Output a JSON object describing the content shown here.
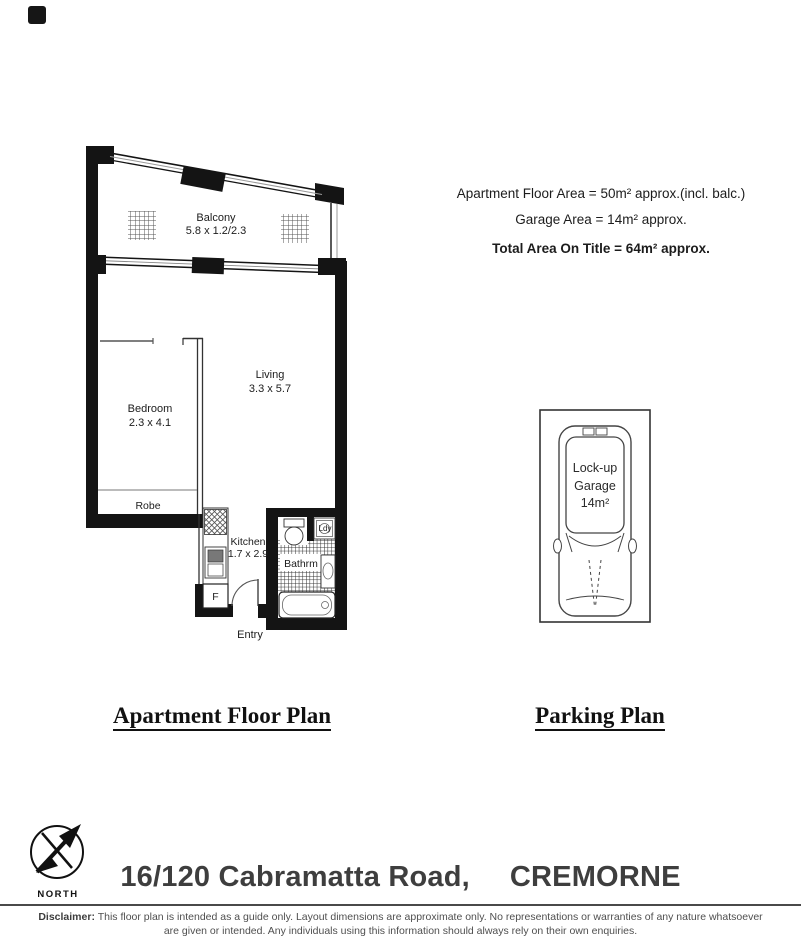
{
  "document": {
    "background": "#ffffff"
  },
  "area_summary": {
    "apartment": "Apartment Floor Area = 50m² approx.(incl. balc.)",
    "garage": "Garage Area = 14m² approx.",
    "total": "Total Area On Title = 64m² approx."
  },
  "floor_plan": {
    "balcony": {
      "name": "Balcony",
      "dims": "5.8 x 1.2/2.3"
    },
    "bedroom": {
      "name": "Bedroom",
      "dims": "2.3 x 4.1"
    },
    "living": {
      "name": "Living",
      "dims": "3.3 x 5.7"
    },
    "kitchen": {
      "name": "Kitchen",
      "dims": "1.7 x 2.9"
    },
    "bathroom": {
      "name": "Bathrm"
    },
    "laundry": {
      "name": "Ldy"
    },
    "robe": {
      "name": "Robe"
    },
    "entry": {
      "name": "Entry"
    },
    "fridge": {
      "name": "F"
    }
  },
  "parking": {
    "line1": "Lock-up",
    "line2": "Garage",
    "area": "14m²"
  },
  "captions": {
    "floor_plan": "Apartment Floor Plan",
    "parking_plan": "Parking Plan"
  },
  "compass": {
    "label": "NORTH"
  },
  "address": {
    "street": "16/120 Cabramatta Road,",
    "suburb": "CREMORNE"
  },
  "disclaimer": {
    "label": "Disclaimer:",
    "line1": "This floor plan is intended as a guide only. Layout dimensions are approximate only. No representations or warranties of any nature whatsoever",
    "line2": "are given or intended.  Any individuals using this information should always rely on their own enquiries."
  },
  "colors": {
    "wall": "#141414",
    "text": "#1c1c1c",
    "address_text": "#3e3e3e",
    "disclaimer_text": "#4f4f4f"
  }
}
